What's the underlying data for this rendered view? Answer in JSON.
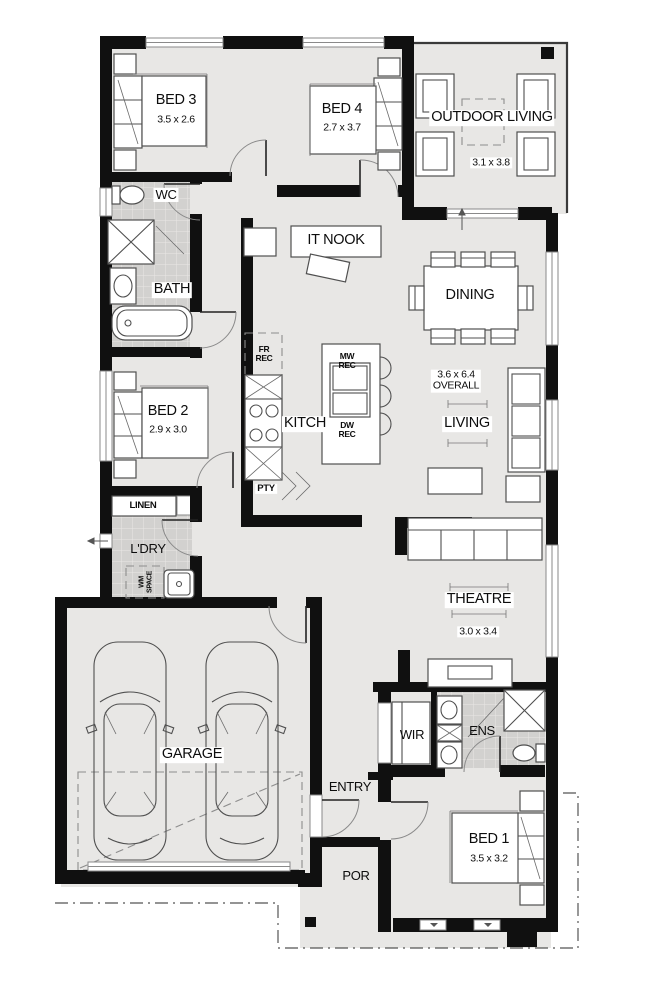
{
  "plan": {
    "rooms": {
      "bed3": {
        "name": "BED 3",
        "dims": "3.5 x 2.6"
      },
      "bed4": {
        "name": "BED 4",
        "dims": "2.7 x 3.7"
      },
      "outdoor_living": {
        "name": "OUTDOOR LIVING",
        "dims": "3.1 x 3.8"
      },
      "wc": {
        "name": "WC"
      },
      "bath": {
        "name": "BATH"
      },
      "it_nook": {
        "name": "IT NOOK"
      },
      "dining": {
        "name": "DINING"
      },
      "living": {
        "name": "LIVING",
        "overall_dims": "3.6 x 6.4\nOVERALL"
      },
      "bed2": {
        "name": "BED 2",
        "dims": "2.9 x 3.0"
      },
      "kitchen": {
        "name": "KITCH"
      },
      "pantry": {
        "name": "PTY"
      },
      "linen": {
        "name": "LINEN"
      },
      "laundry": {
        "name": "L'DRY"
      },
      "wm_space": {
        "name": "WM\nSPACE"
      },
      "theatre": {
        "name": "THEATRE",
        "dims": "3.0 x 3.4"
      },
      "garage": {
        "name": "GARAGE"
      },
      "wir": {
        "name": "WIR"
      },
      "ens": {
        "name": "ENS"
      },
      "entry": {
        "name": "ENTRY"
      },
      "bed1": {
        "name": "BED 1",
        "dims": "3.5 x 3.2"
      },
      "porch": {
        "name": "POR"
      }
    },
    "appliance_labels": {
      "fridge_recess": "FR\nREC",
      "microwave_recess": "MW\nREC",
      "dishwasher_recess": "DW\nREC"
    },
    "colors": {
      "wall": "#101010",
      "floor": "#e8e7e5",
      "tile": "#d2d1cf",
      "background": "#ffffff"
    }
  }
}
